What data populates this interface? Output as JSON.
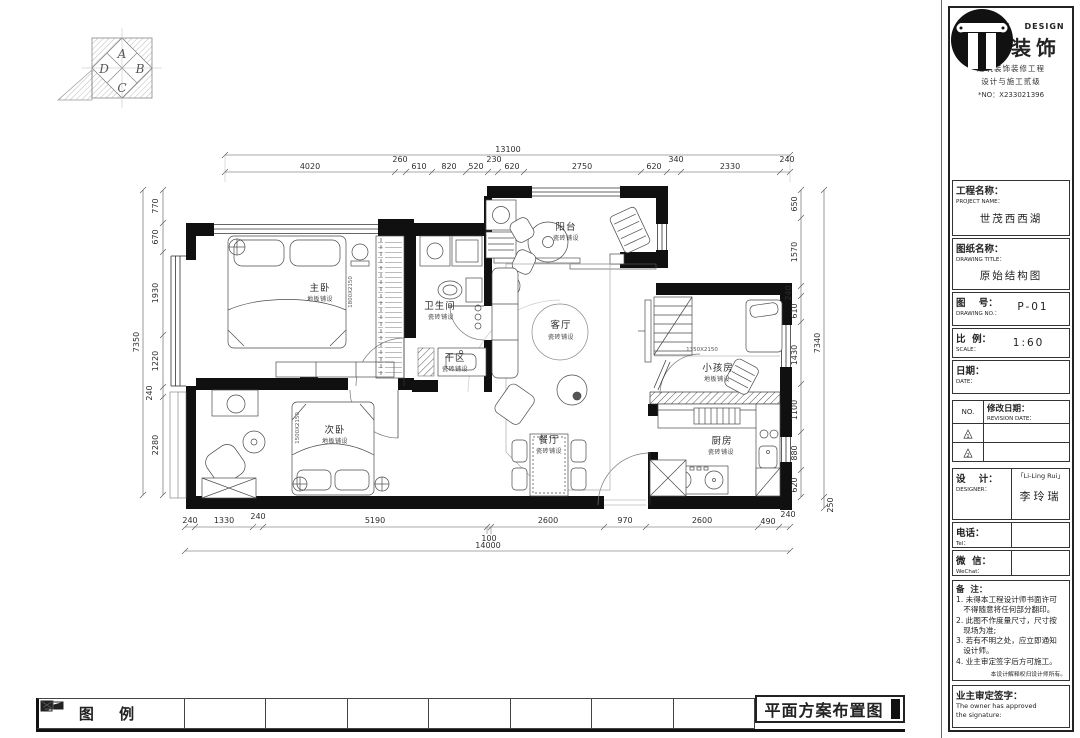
{
  "compass": {
    "a": "A",
    "b": "B",
    "c": "C",
    "d": "D"
  },
  "rooms": {
    "master": {
      "name": "主卧",
      "finish": "地板铺设"
    },
    "bath": {
      "name": "卫生间",
      "finish": "瓷砖铺设"
    },
    "balcony": {
      "name": "阳台",
      "finish": "瓷砖铺设"
    },
    "living": {
      "name": "客厅",
      "finish": "瓷砖铺设"
    },
    "dry": {
      "name": "干区",
      "finish": "瓷砖铺设"
    },
    "second": {
      "name": "次卧",
      "finish": "地板铺设"
    },
    "dining": {
      "name": "餐厅",
      "finish": "瓷砖铺设"
    },
    "kids": {
      "name": "小孩房",
      "finish": "地板铺设"
    },
    "kitchen": {
      "name": "厨房",
      "finish": "瓷砖铺设"
    }
  },
  "beds": {
    "master": "1800X2150",
    "second": "1500X2150",
    "kids": "1350X2150"
  },
  "dims": {
    "top_total": "13100",
    "top": [
      "4020",
      "260",
      "610",
      "820",
      "520",
      "230",
      "620",
      "2750",
      "620",
      "340",
      "2330",
      "240"
    ],
    "left_total": "7350",
    "left": [
      "770",
      "670",
      "1930",
      "1220",
      "240",
      "2280"
    ],
    "right_total": "7340",
    "right": [
      "650",
      "1570",
      "240",
      "610",
      "1430",
      "1100",
      "880",
      "620"
    ],
    "right_extra": "250",
    "bottom_total": "14000",
    "bottom": [
      "240",
      "1330",
      "240",
      "5190",
      "100",
      "2600",
      "970",
      "2600",
      "490",
      "240"
    ]
  },
  "titleblock": {
    "brand_en": "NANHONG DESIGN",
    "brand_cn": "南鸿装饰",
    "brand_sub1": "建筑装饰装修工程",
    "brand_sub2": "设计与施工贰级",
    "brand_no": "*NO：X233021396",
    "project_label": "工程名称：",
    "project_en": "PROJECT NAME：",
    "project_value": "世茂西西湖",
    "drawing_label": "图纸名称：",
    "drawing_en": "DRAWING TITLE：",
    "drawing_value": "原始结构图",
    "number_label": "图    号：",
    "number_en": "DRAWING NO.：",
    "number_value": "P-01",
    "scale_label": "比  例：",
    "scale_en": "SCALE：",
    "scale_value": "1:60",
    "date_label": "日期：",
    "date_en": "DATE：",
    "rev_no": "NO.",
    "rev_label": "修改日期：",
    "rev_en": "REVISION DATE：",
    "rev_rows": [
      "1",
      "2"
    ],
    "designer_label": "设    计：",
    "designer_en": "DESIGNER：",
    "designer_sig": "「Li-Ling Rui」",
    "designer_value": "李玲瑞",
    "tel_label": "电话：",
    "tel_en": "Tel：",
    "wechat_label": "微  信：",
    "wechat_en": "WeChat：",
    "notes_label": "备  注：",
    "notes": [
      "1. 未得本工程设计师书面许可",
      "   不得随意将任何部分翻印。",
      "2. 此图不作度量尺寸，尺寸按",
      "   现场为准;",
      "3. 若有不明之处，应立即通知",
      "   设计师。",
      "4. 业主审定签字后方可施工。"
    ],
    "notes_footer": "本设计解释权归设计师所有。",
    "owner_label": "业主审定签字：",
    "owner_en1": "The owner has approved",
    "owner_en2": "the signature:"
  },
  "footer": {
    "legend_title": "图 例",
    "sheet_title": "平面方案布置图"
  }
}
